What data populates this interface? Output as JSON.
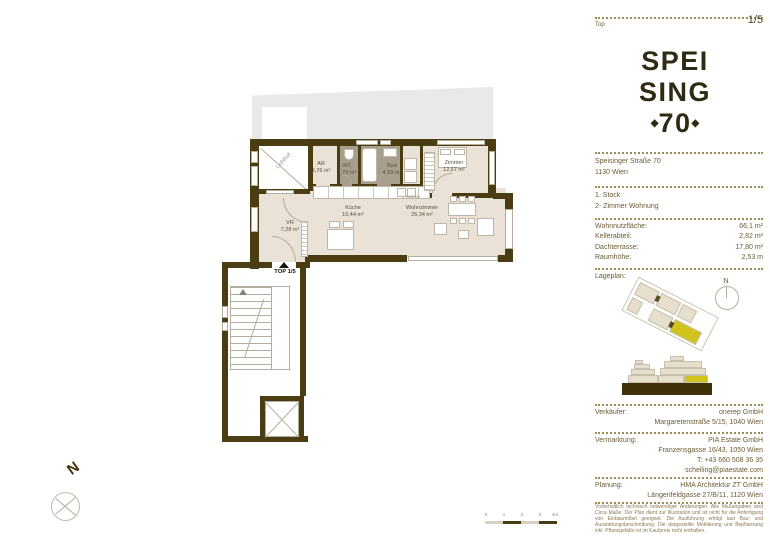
{
  "header": {
    "top_label": "Top",
    "page": "1/5"
  },
  "logo": {
    "line1": "SPEI",
    "line2": "SING",
    "number": "70",
    "ornament": "◆"
  },
  "address": {
    "street": "Speisinger Straße 70",
    "city": "1130 Wien"
  },
  "unit": {
    "floor": "1. Stock",
    "type": "2- Zimmer Wohnung"
  },
  "specs": {
    "rows": [
      {
        "label": "Wohnnutzfläche:",
        "value": "66,1 m²"
      },
      {
        "label": "Kellerabteil:",
        "value": "2,82 m²"
      },
      {
        "label": "Dachterrasse:",
        "value": "17,80 m²"
      },
      {
        "label": "Raumhöhe:",
        "value": "2,53 m"
      }
    ]
  },
  "lageplan": {
    "label": "Lageplan:",
    "compass": "N"
  },
  "contacts": {
    "verkaeufer": {
      "label": "Verkäufer:",
      "line1": "onerep GmbH",
      "line2": "Margaretenstraße 5/15, 1040 Wien"
    },
    "vermarktung": {
      "label": "Vermarktung:",
      "line1": "PIA Estate GmbH",
      "line2": "Franzensgasse 16/43, 1050 Wien",
      "line3": "T: +43 660 508 36 35",
      "line4": "schelling@piaestate.com"
    },
    "planung": {
      "label": "Planung:",
      "line1": "HMA Architektur ZT GmbH",
      "line2": "Längenfeldgasse 27/B/11, 1120 Wien"
    }
  },
  "disclaimer": "Vorbehaltlich technisch notwendiger Änderungen. Alle Maßangaben sind Circa Maße. Der Plan dient zur Illustration und ist nicht für die Anfertigung von Einbaumöbel geeignet. Die Ausführung erfolgt laut Bau- und Ausstattungsbeschreibung. Die dargestellte Möblierung und Bepflanzung inkl. Pflanzgefäße ist im Kaufpreis nicht enthalten.",
  "plan": {
    "entrance_label": "TOP 1/5",
    "compass": "N",
    "closet_label": "KLEIDE",
    "rooms": {
      "lichthof": {
        "name": "Lichthof"
      },
      "ar": {
        "name": "AR",
        "area": "3,76 m²"
      },
      "wc": {
        "name": "WC",
        "area": "1,70 m²"
      },
      "bad": {
        "name": "Bad",
        "area": "4,89 m²"
      },
      "zimmer": {
        "name": "Zimmer",
        "area": "12,67 m²"
      },
      "kueche": {
        "name": "Küche",
        "area": "10,44 m²"
      },
      "wohnzimmer": {
        "name": "Wohnzimmer",
        "area": "25,34 m²"
      },
      "vr": {
        "name": "VR",
        "area": "7,28 m²"
      }
    }
  },
  "scalebar": {
    "labels": [
      "0",
      "1",
      "2",
      "3",
      "4m"
    ]
  },
  "colors": {
    "wall": "#4a3d12",
    "floor": "#eae2d6",
    "wet_room": "#a89e8e",
    "roof": "#e9e9e7",
    "accent_yellow": "#d2c31c"
  }
}
